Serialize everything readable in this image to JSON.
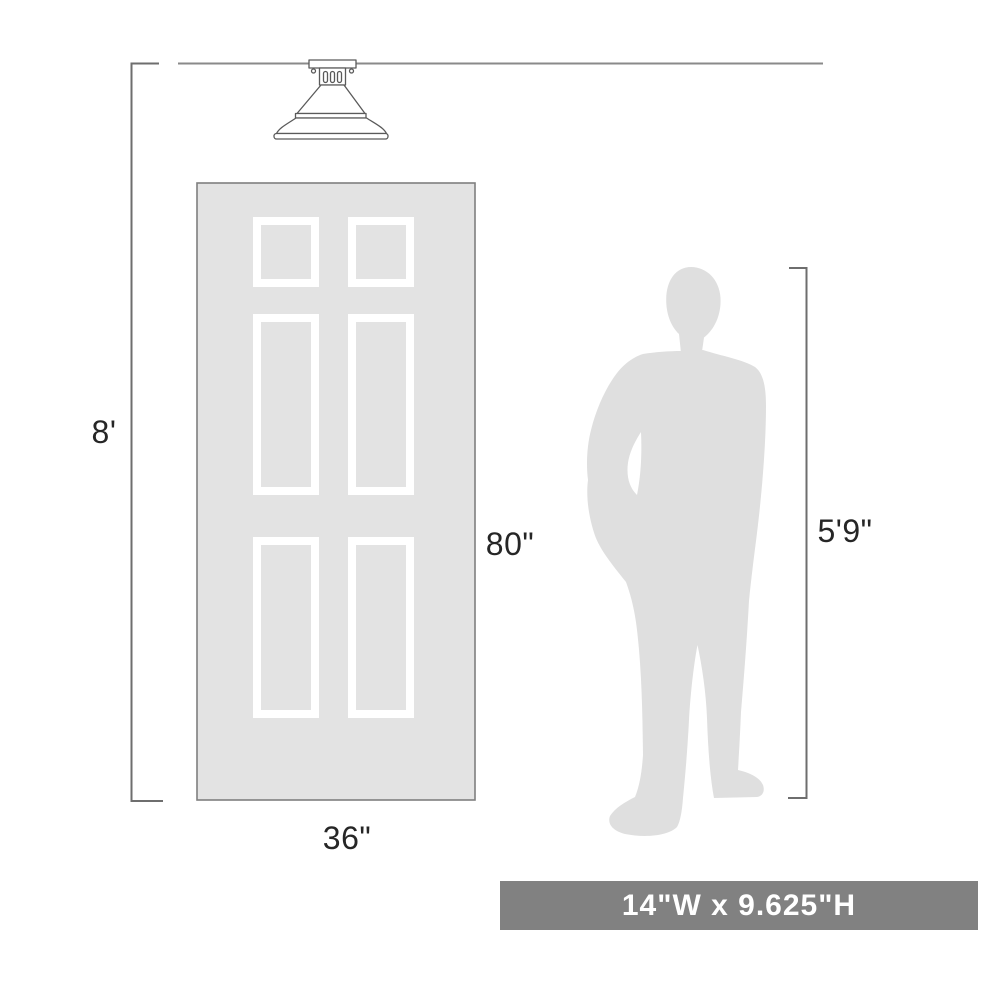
{
  "labels": {
    "ceiling_height": "8'",
    "door_height": "80\"",
    "door_width": "36\"",
    "person_height": "5'9\""
  },
  "banner": {
    "text": "14\"W x 9.625\"H"
  },
  "icons": {
    "fixture": "flush-mount-ceiling-light-line-drawing",
    "door": "six-panel-door-illustration",
    "person": "standing-man-silhouette"
  },
  "colors": {
    "bg": "#ffffff",
    "ink": "#262626",
    "line": "#6e6e6e",
    "ceiling_line": "#8a8a8a",
    "door_fill": "#e3e3e3",
    "door_border": "#7f7f7f",
    "panel_frame": "#ffffff",
    "silhouette_fill": "#dfdfdf",
    "fixture_stroke": "#5a5a5a",
    "fixture_fill": "#ffffff",
    "banner_bg": "#818181",
    "banner_fg": "#ffffff"
  }
}
